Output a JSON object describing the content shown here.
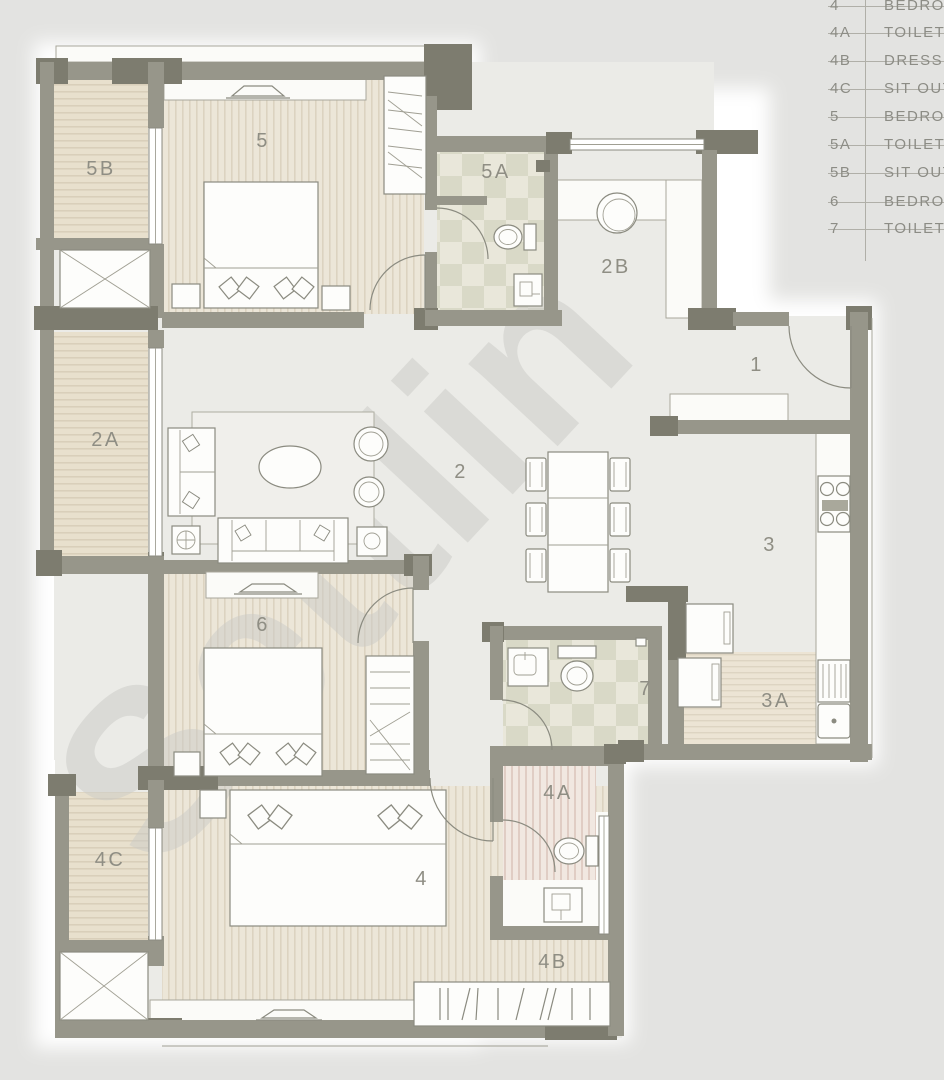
{
  "watermark": {
    "text": "Settlin"
  },
  "legend": {
    "rows": [
      {
        "code": "4",
        "label": "BEDROOM"
      },
      {
        "code": "4A",
        "label": "TOILET"
      },
      {
        "code": "4B",
        "label": "DRESS"
      },
      {
        "code": "4C",
        "label": "SIT OUT"
      },
      {
        "code": "5",
        "label": "BEDROOM"
      },
      {
        "code": "5A",
        "label": "TOILET"
      },
      {
        "code": "5B",
        "label": "SIT OUT"
      },
      {
        "code": "6",
        "label": "BEDROOM"
      },
      {
        "code": "7",
        "label": "TOILET"
      }
    ]
  },
  "rooms": [
    {
      "label": "5"
    },
    {
      "label": "5B"
    },
    {
      "label": "5A"
    },
    {
      "label": "2B"
    },
    {
      "label": "1"
    },
    {
      "label": "2A"
    },
    {
      "label": "2"
    },
    {
      "label": "3"
    },
    {
      "label": "6"
    },
    {
      "label": "7"
    },
    {
      "label": "3A"
    },
    {
      "label": "4A"
    },
    {
      "label": "4C"
    },
    {
      "label": "4"
    },
    {
      "label": "4B"
    }
  ],
  "palette": {
    "background": "#e3e3e1",
    "wall": "#97968a",
    "wall_dark": "#7d7c6f",
    "floor": "#ebebe7",
    "stripe_beige": "#ece6d8",
    "balcony_beige": "#e8e0cd",
    "checker_green": "#d9d9c7",
    "stripe_pink": "#f1e8e1",
    "line": "#8b8b80",
    "label_text": "#8f8e84",
    "legend_text": "#8c8c85",
    "watermark": "#cbcbc7",
    "white": "#ffffff"
  }
}
